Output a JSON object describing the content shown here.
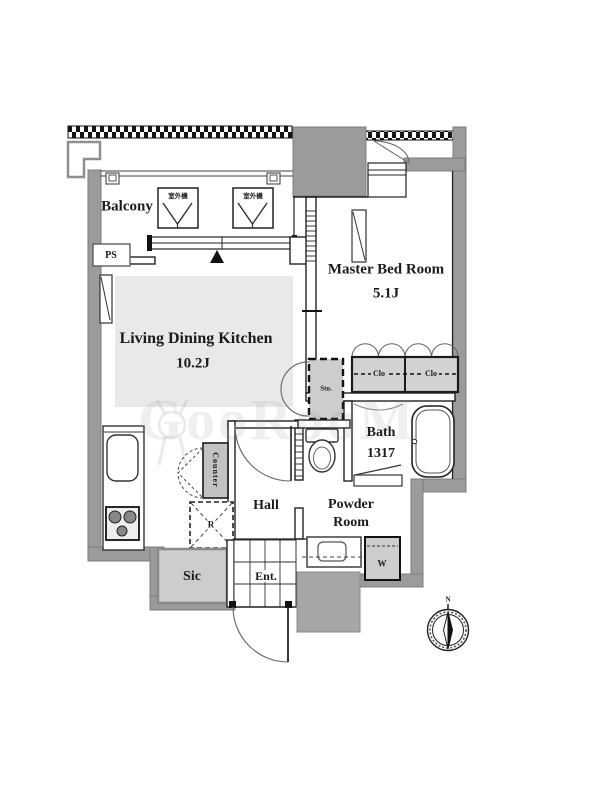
{
  "meta": {
    "kind": "apartment-floor-plan"
  },
  "watermark": {
    "text": "GooRooM"
  },
  "compass": {
    "label": "N"
  },
  "rooms": {
    "balcony": {
      "label": "Balcony"
    },
    "master_bedroom": {
      "name": "Master Bed Room",
      "size": "5.1J"
    },
    "ldk": {
      "name": "Living Dining Kitchen",
      "size": "10.2J"
    },
    "bath": {
      "name": "Bath",
      "size": "1317"
    },
    "powder_room": {
      "line1": "Powder",
      "line2": "Room"
    },
    "hall": {
      "label": "Hall"
    },
    "entrance": {
      "label": "Ent."
    },
    "shoes_closet": {
      "label": "Sic"
    }
  },
  "fixtures": {
    "pipe_space": "PS",
    "storage": "Sto.",
    "closet_left": "Clo",
    "closet_right": "Clo",
    "washing_machine": "W",
    "kitchen_counter": "Counter",
    "refrigerator": "R",
    "ac_outdoor_unit_left": "室外機",
    "ac_outdoor_unit_right": "室外機"
  },
  "colors": {
    "wall": "#9b9b9b",
    "line": "#222222",
    "floor_shade": "#e9e9e9",
    "fixture_fill": "#cdcdcd",
    "outside_block": "#a6a6a6"
  }
}
